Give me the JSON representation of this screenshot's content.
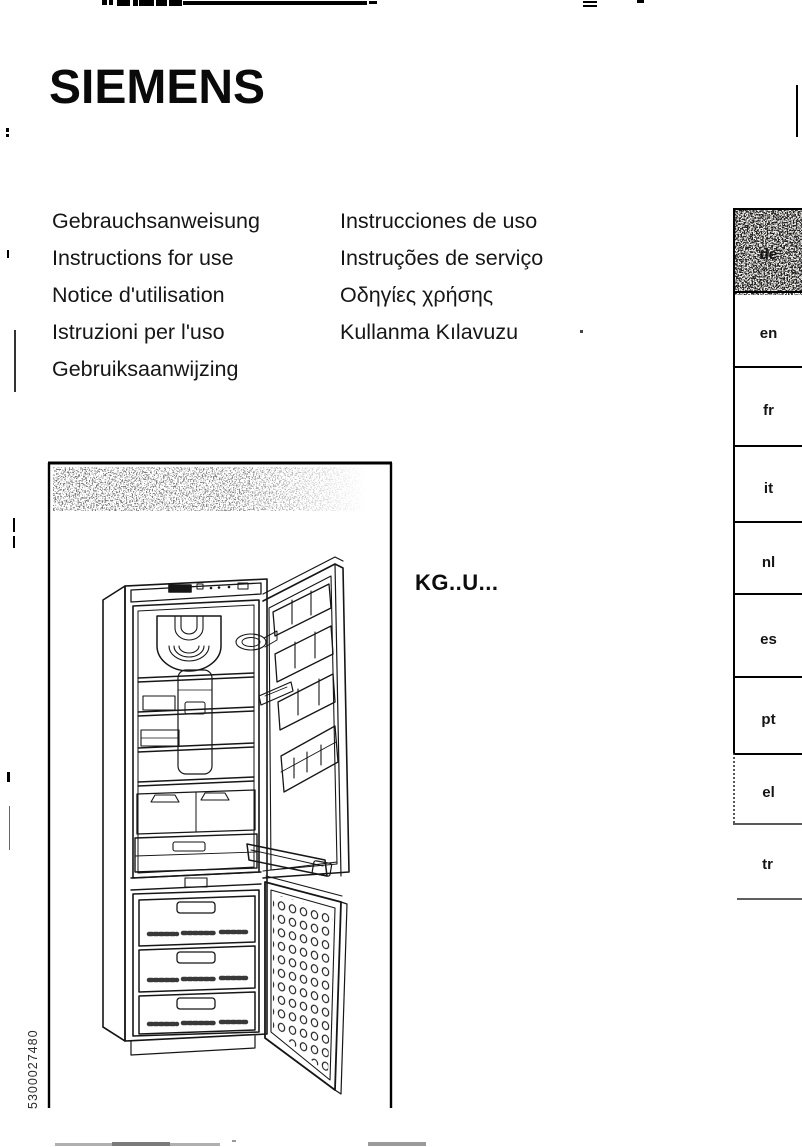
{
  "brand": {
    "logo": "SIEMENS"
  },
  "titles": {
    "column1": [
      "Gebrauchsanweisung",
      "Instructions for use",
      "Notice d'utilisation",
      "Istruzioni per l'uso",
      "Gebruiksaanwijzing"
    ],
    "column2": [
      "Instrucciones de uso",
      "Instruções de serviço",
      "Οδηγίες χρήσης",
      "Kullanma Kılavuzu"
    ]
  },
  "model_label": "KG..U...",
  "language_tabs": [
    "de",
    "en",
    "fr",
    "it",
    "nl",
    "es",
    "pt",
    "el",
    "tr"
  ],
  "active_tab": "de",
  "document_number": "5300027480",
  "illustration": {
    "description": "fridge-freezer with both doors open, line drawing"
  },
  "colors": {
    "ink": "#111111",
    "paper": "#ffffff",
    "active_tab_base": "#eceae6"
  }
}
